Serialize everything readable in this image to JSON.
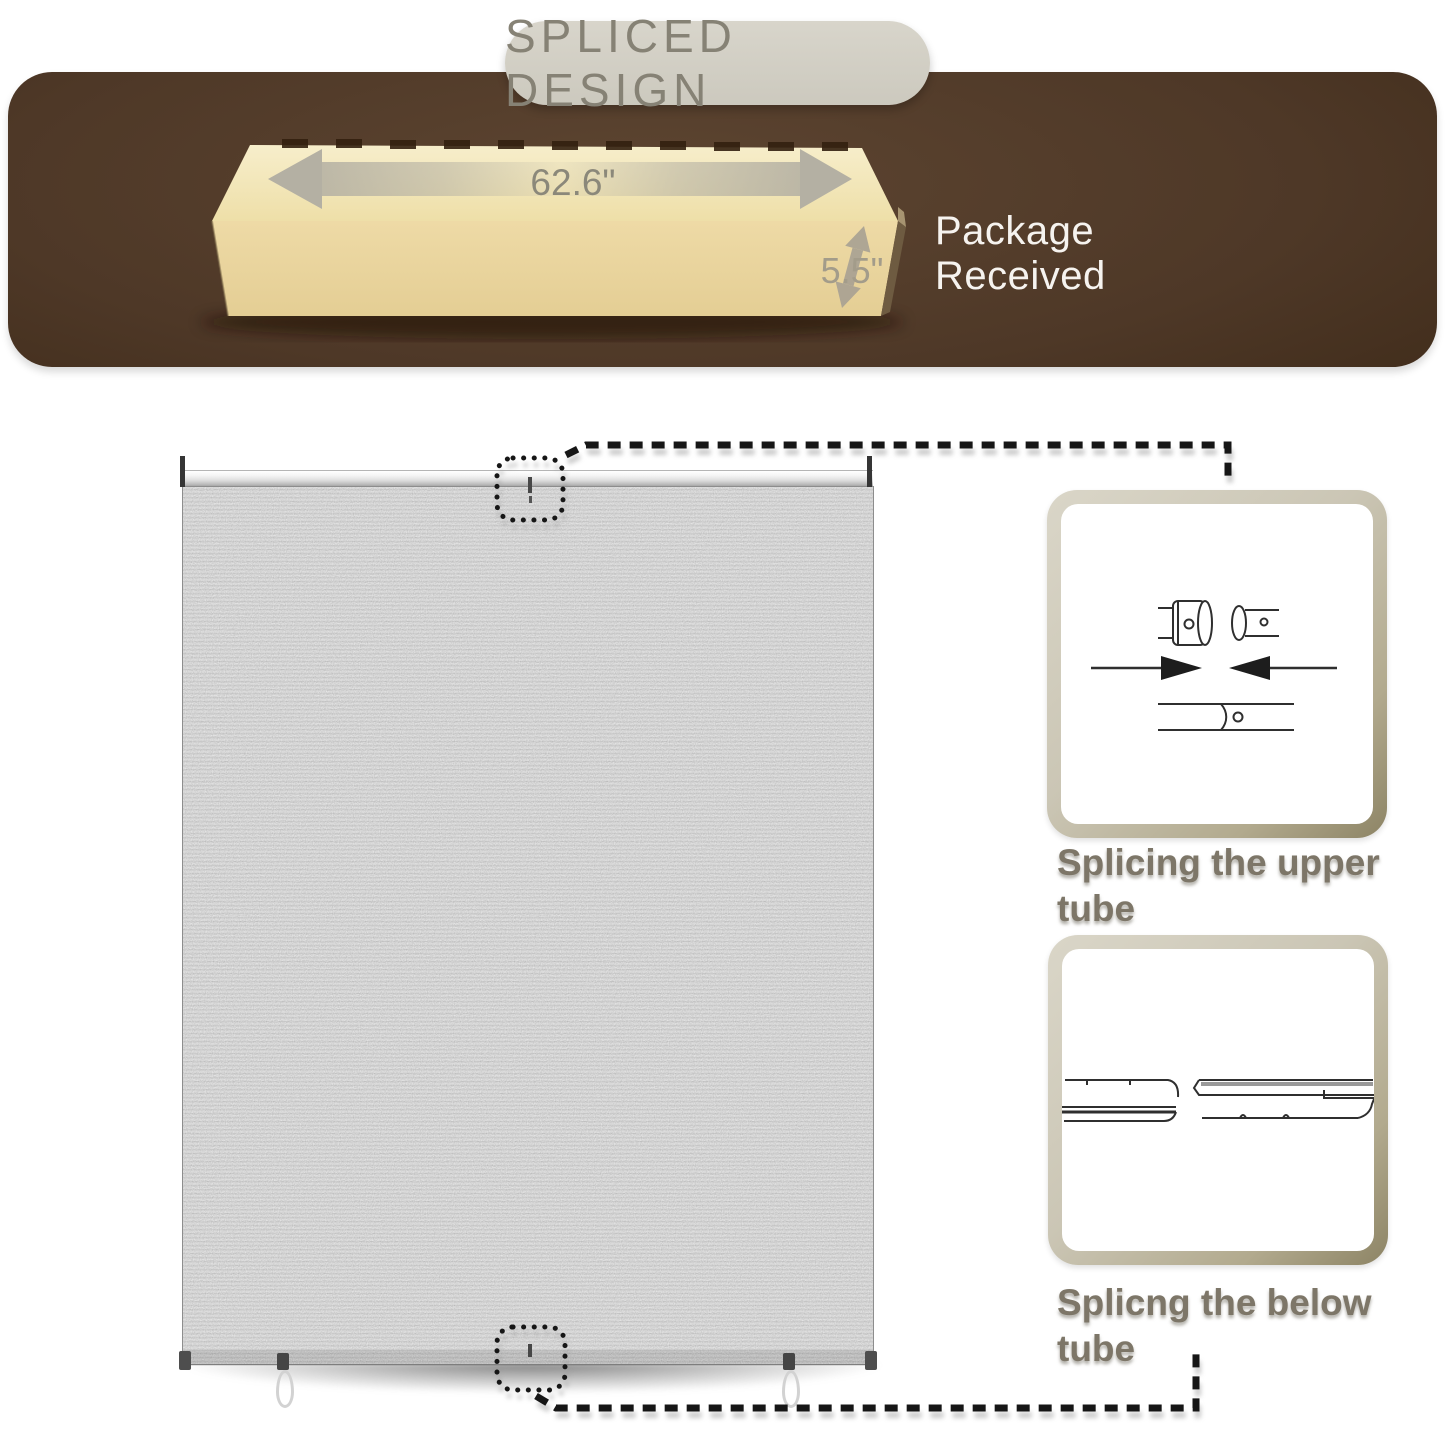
{
  "page": {
    "width": 1445,
    "height": 1445,
    "background": "#ffffff"
  },
  "title_badge": {
    "label": "SPLICED DESIGN",
    "bg": "#d2cfc4",
    "text_color": "#868275"
  },
  "package_banner": {
    "status_label": "Package Received",
    "box_width_label": "62.6\"",
    "box_height_label": "5.5\"",
    "banner_color_center": "#54402c",
    "banner_color_edge": "#2b1a0c",
    "carton_top_color": "#f4e9c4",
    "carton_front_color": "#ecd8a2",
    "dimension_arrow_color": "#b4b0a3",
    "icons": {
      "width_arrow": "double-headed-horizontal-arrow",
      "height_arrow": "double-headed-vertical-arrow"
    }
  },
  "shade": {
    "fabric_color": "#a9a9a9",
    "upper_marker": "dotted-square-highlight",
    "lower_marker": "dotted-square-highlight"
  },
  "callouts": {
    "upper": {
      "caption_line1": "Splicing the upper",
      "caption_line2": "tube",
      "diagram": "upper-tube-splice-diagram"
    },
    "lower": {
      "caption_line1": "Splicng the below",
      "caption_line2": "tube",
      "diagram": "bottom-rail-splice-diagram"
    }
  },
  "styles": {
    "caption_color": "#7d7668",
    "connector_color": "#161616",
    "callout_frame_color": "#c8c3b2"
  }
}
